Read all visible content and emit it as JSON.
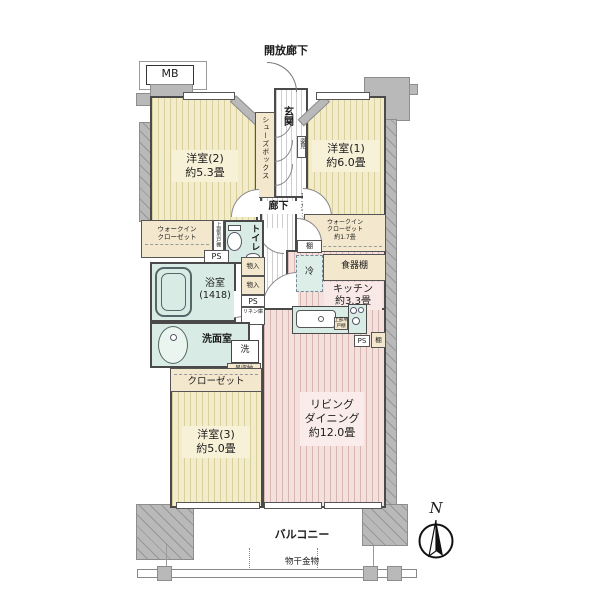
{
  "plan": {
    "top": {
      "open_corridor": "開放廊下",
      "mb": "MB"
    },
    "rooms": {
      "room1": {
        "name": "洋室(1)",
        "size": "約6.0畳"
      },
      "room2": {
        "name": "洋室(2)",
        "size": "約5.3畳"
      },
      "room3": {
        "name": "洋室(3)",
        "size": "約5.0畳"
      },
      "living": {
        "l1": "リビング",
        "l2": "ダイニング",
        "l3": "約12.0畳"
      },
      "kitchen": {
        "name": "キッチン",
        "size": "約3.3畳"
      },
      "bath": {
        "name": "浴室",
        "size": "(1418)"
      },
      "washroom": "洗面室",
      "toilet": "トイレ",
      "genkan": "玄関",
      "corridor": "廊下"
    },
    "storage": {
      "shoes_box": "シューズボックス",
      "wic_left": {
        "l1": "ウォークイン",
        "l2": "クローゼット"
      },
      "wic_right": {
        "l1": "ウォークイン",
        "l2": "クローゼット",
        "l3": "約1.7畳"
      },
      "closet": "クローゼット",
      "dish_shelf": "食器棚",
      "shelf": "棚",
      "shelf2": "棚",
      "mono_ire": "物入",
      "linen": "リネン庫",
      "upper_cabinet_v": "上部吊戸棚",
      "kitchen_upper": "上部吊戸棚",
      "hang_storage": "吊収納"
    },
    "fixtures": {
      "fridge": "冷",
      "laundry": "洗",
      "ps": "PS",
      "sugatami": "姿見",
      "ecocarat": "エコカラット"
    },
    "balcony": {
      "label": "バルコニー",
      "hardware": "物干金物"
    },
    "compass_n": "N"
  },
  "colors": {
    "wood_floor": "#f3ecca",
    "wood_stripe": "#d9d09e",
    "pink_floor": "#f4e1de",
    "pink_stripe": "#d8b6b2",
    "wet_area": "#d8ebe4",
    "closet": "#f3e7cd",
    "concrete": "#b9b9b9",
    "wall": "#4a4a4a"
  }
}
